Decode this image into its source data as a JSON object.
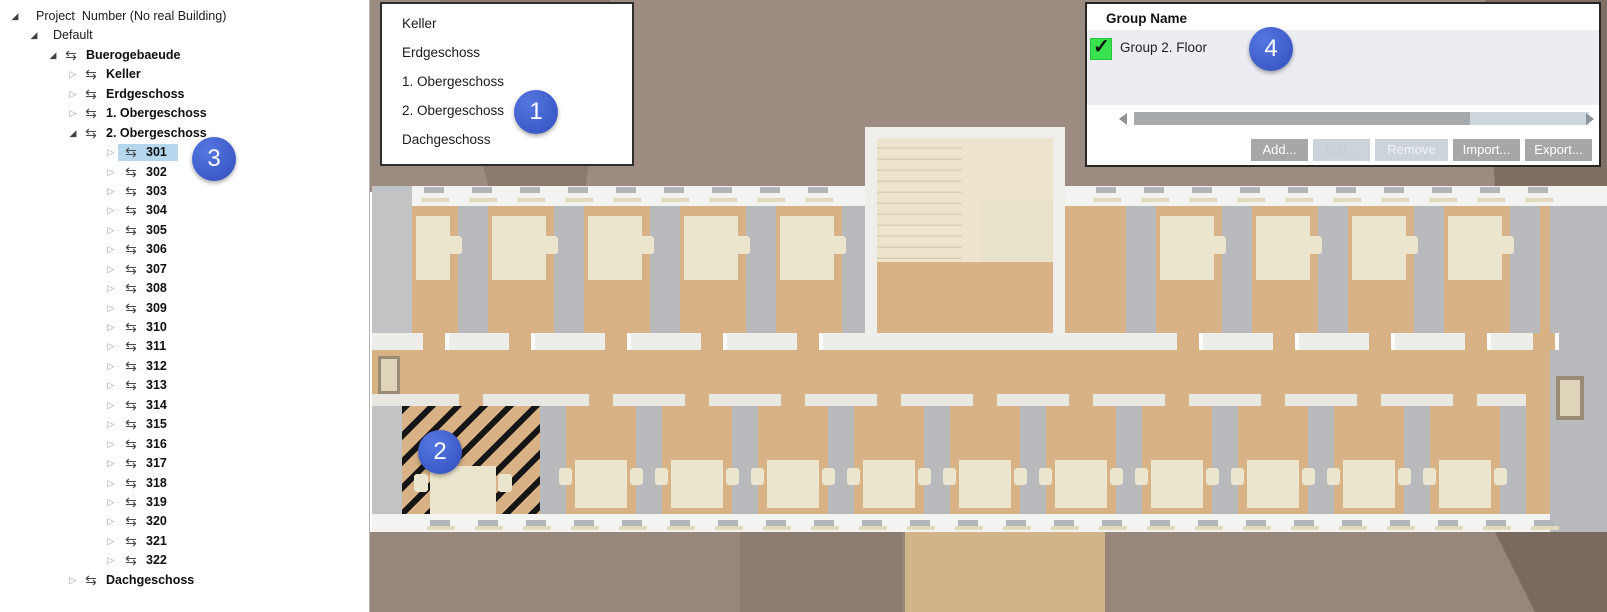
{
  "tree": {
    "items": [
      {
        "label": "Project  Number (No real Building)",
        "level": 0,
        "state": "expanded",
        "icon": false,
        "bold": false
      },
      {
        "label": "Default",
        "level": 1,
        "state": "expanded",
        "icon": false,
        "bold": false
      },
      {
        "label": "Buerogebaeude",
        "level": 2,
        "state": "expanded",
        "icon": true,
        "bold": true
      },
      {
        "label": "Keller",
        "level": 3,
        "state": "collapsed",
        "icon": true,
        "bold": true
      },
      {
        "label": "Erdgeschoss",
        "level": 3,
        "state": "collapsed",
        "icon": true,
        "bold": true
      },
      {
        "label": "1. Obergeschoss",
        "level": 3,
        "state": "collapsed",
        "icon": true,
        "bold": true
      },
      {
        "label": "2. Obergeschoss",
        "level": 3,
        "state": "expanded",
        "icon": true,
        "bold": true
      },
      {
        "label": "301",
        "level": 4,
        "state": "collapsed",
        "icon": true,
        "bold": true,
        "selected": true
      },
      {
        "label": "302",
        "level": 4,
        "state": "collapsed",
        "icon": true,
        "bold": true
      },
      {
        "label": "303",
        "level": 4,
        "state": "collapsed",
        "icon": true,
        "bold": true
      },
      {
        "label": "304",
        "level": 4,
        "state": "collapsed",
        "icon": true,
        "bold": true
      },
      {
        "label": "305",
        "level": 4,
        "state": "collapsed",
        "icon": true,
        "bold": true
      },
      {
        "label": "306",
        "level": 4,
        "state": "collapsed",
        "icon": true,
        "bold": true
      },
      {
        "label": "307",
        "level": 4,
        "state": "collapsed",
        "icon": true,
        "bold": true
      },
      {
        "label": "308",
        "level": 4,
        "state": "collapsed",
        "icon": true,
        "bold": true
      },
      {
        "label": "309",
        "level": 4,
        "state": "collapsed",
        "icon": true,
        "bold": true
      },
      {
        "label": "310",
        "level": 4,
        "state": "collapsed",
        "icon": true,
        "bold": true
      },
      {
        "label": "311",
        "level": 4,
        "state": "collapsed",
        "icon": true,
        "bold": true
      },
      {
        "label": "312",
        "level": 4,
        "state": "collapsed",
        "icon": true,
        "bold": true
      },
      {
        "label": "313",
        "level": 4,
        "state": "collapsed",
        "icon": true,
        "bold": true
      },
      {
        "label": "314",
        "level": 4,
        "state": "collapsed",
        "icon": true,
        "bold": true
      },
      {
        "label": "315",
        "level": 4,
        "state": "collapsed",
        "icon": true,
        "bold": true
      },
      {
        "label": "316",
        "level": 4,
        "state": "collapsed",
        "icon": true,
        "bold": true
      },
      {
        "label": "317",
        "level": 4,
        "state": "collapsed",
        "icon": true,
        "bold": true
      },
      {
        "label": "318",
        "level": 4,
        "state": "collapsed",
        "icon": true,
        "bold": true
      },
      {
        "label": "319",
        "level": 4,
        "state": "collapsed",
        "icon": true,
        "bold": true
      },
      {
        "label": "320",
        "level": 4,
        "state": "collapsed",
        "icon": true,
        "bold": true
      },
      {
        "label": "321",
        "level": 4,
        "state": "collapsed",
        "icon": true,
        "bold": true
      },
      {
        "label": "322",
        "level": 4,
        "state": "collapsed",
        "icon": true,
        "bold": true
      },
      {
        "label": "Dachgeschoss",
        "level": 3,
        "state": "collapsed",
        "icon": true,
        "bold": true
      }
    ],
    "icon_glyph": "⇆",
    "selected_bg": "#b5d7ee"
  },
  "floor_menu": {
    "items": [
      "Keller",
      "Erdgeschoss",
      "1. Obergeschoss",
      "2. Obergeschoss",
      "Dachgeschoss"
    ]
  },
  "group_panel": {
    "header": "Group Name",
    "rows": [
      {
        "name": "Group 2. Floor",
        "checked": true
      }
    ],
    "checkbox_color": "#3ae24f",
    "buttons": [
      {
        "label": "Add...",
        "enabled": true,
        "width": 57
      },
      {
        "label": "Edit...",
        "enabled": false,
        "dim": true,
        "width": 57
      },
      {
        "label": "Remove",
        "enabled": false,
        "dim": false,
        "width": 73
      },
      {
        "label": "Import...",
        "enabled": true,
        "width": 67
      },
      {
        "label": "Export...",
        "enabled": true,
        "width": 67
      }
    ]
  },
  "annotations": [
    {
      "n": "1",
      "x": 536,
      "y": 112
    },
    {
      "n": "2",
      "x": 440,
      "y": 452
    },
    {
      "n": "3",
      "x": 214,
      "y": 159
    },
    {
      "n": "4",
      "x": 1271,
      "y": 49
    }
  ],
  "annotation_color": "#3e5fd0",
  "colors": {
    "plan": {
      "exterior_top": "#9c8b80",
      "exterior_bottom": "#97867b",
      "exterior_dark": "#8a7a6e",
      "exterior_darker": "#7f6f63",
      "exterior_patch": "#8d7c71",
      "exterior_corner": "#79695e",
      "terrace": "#d2b48b",
      "floor": "#d8b284",
      "wall": "#b9babd",
      "wall_light": "#c7c8ca",
      "end_wall": "#c2c3c5",
      "band": "#f3f3f1",
      "mid_band": "#ededea",
      "band2": "#e9e7e2",
      "desk": "#ece5cd",
      "stairs": "#ece4cc",
      "stair_wall": "#efeeeb",
      "stair_side": "#e9e2ca",
      "tread": "#d9cfb4",
      "hatch": "#151515",
      "window_sill": "#e3d9bd",
      "window_mark": "#b3b5b8",
      "door": "#ddd4ba",
      "door_frame": "#9a8b74",
      "door_leaf": "#fafaf8"
    }
  }
}
